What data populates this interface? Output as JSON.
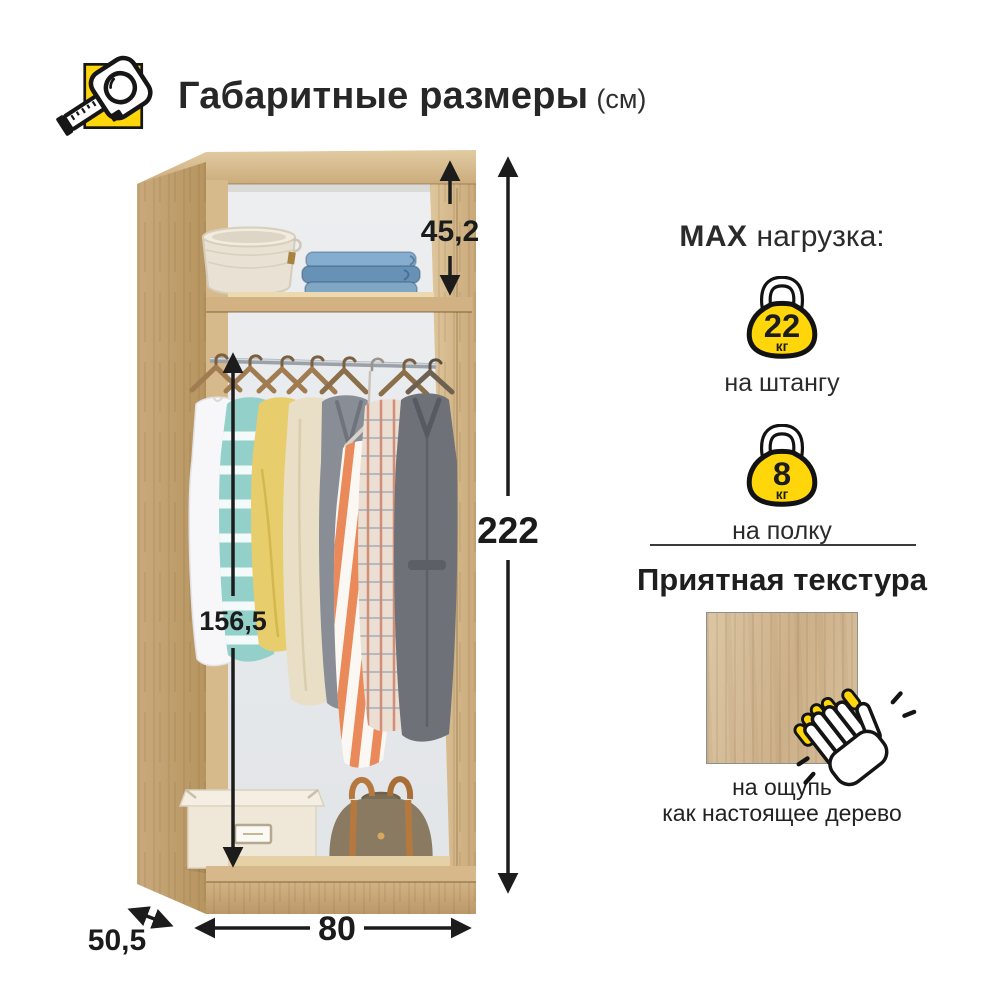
{
  "header": {
    "icon": "tape-measure-icon",
    "title": "Габаритные размеры",
    "unit": "(см)"
  },
  "dimensions_cm": {
    "top_section_height": "45,2",
    "total_height": "222",
    "hanging_section_height": "156,5",
    "width": "80",
    "depth": "50,5"
  },
  "max_load": {
    "prefix": "MAX",
    "suffix": "нагрузка:",
    "items": [
      {
        "icon": "kettlebell-icon",
        "value": "22",
        "unit": "кг",
        "label": "на штангу"
      },
      {
        "icon": "kettlebell-icon",
        "value": "8",
        "unit": "кг",
        "label": "на полку"
      }
    ]
  },
  "texture": {
    "title": "Приятная текстура",
    "swatch": "wood-texture-swatch",
    "icon": "clapping-hand-icon",
    "caption_line1": "на ощупь",
    "caption_line2": "как настоящее дерево"
  },
  "illustration": {
    "subject": "open-wardrobe-carcass",
    "top_shelf_items": [
      "wicker-basket",
      "folded-jeans"
    ],
    "hanging_items": [
      "white-shirt",
      "striped-sweater",
      "yellow-sweater",
      "beige-cardigan",
      "grey-jacket",
      "striped-dress",
      "plaid-shirt",
      "grey-coat"
    ],
    "floor_items": [
      "storage-box",
      "travel-bag"
    ]
  },
  "colors": {
    "accent_yellow": "#FFD60A",
    "wood": "#D2B488",
    "interior": "#EDEFF1",
    "text": "#1F1F1F",
    "arrow": "#1C1C1C"
  }
}
